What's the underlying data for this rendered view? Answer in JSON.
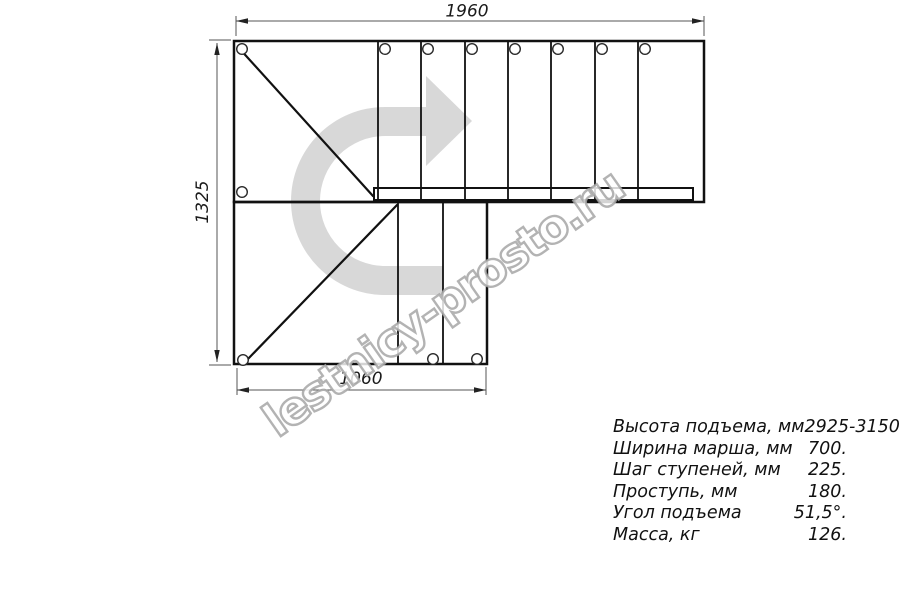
{
  "drawing": {
    "dimensions": {
      "top_width": "1960",
      "left_height": "1325",
      "bottom_width": "1060"
    },
    "watermark": "lestnicy-prosto.ru",
    "colors": {
      "line": "#111111",
      "dim": "#555555",
      "arrow_fill": "#d8d8d8",
      "watermark_stroke": "#a6a6a6",
      "background": "#ffffff"
    }
  },
  "specs": {
    "rows": [
      {
        "label": "Высота подъема, мм",
        "value": "2925-3150."
      },
      {
        "label": "Ширина марша, мм",
        "value": "700."
      },
      {
        "label": "Шаг ступеней, мм",
        "value": "225."
      },
      {
        "label": "Проступь, мм",
        "value": "180."
      },
      {
        "label": "Угол подъема",
        "value": "51,5°."
      },
      {
        "label": "Масса, кг",
        "value": "126."
      }
    ]
  }
}
